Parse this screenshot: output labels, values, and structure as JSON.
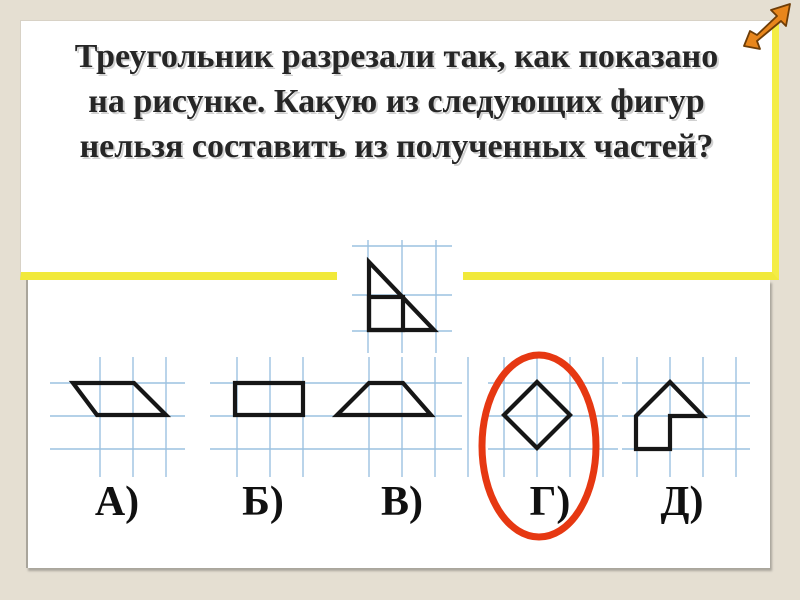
{
  "title": {
    "lines": [
      "Треугольник разрезали так, как показано",
      "на рисунке. Какую из следующих фигур",
      "нельзя составить из полученных частей?"
    ]
  },
  "figure": {
    "name": "cut-triangle-figure",
    "backing": [
      337,
      236,
      126,
      56
    ],
    "grid": {
      "v": [
        368,
        402,
        436
      ],
      "vy": [
        240,
        353
      ],
      "h": [
        246,
        295,
        331
      ],
      "hx": [
        352,
        452
      ]
    },
    "shapes": [
      {
        "polygon": [
          [
            369,
            262
          ],
          [
            369,
            330
          ],
          [
            434,
            330
          ]
        ]
      },
      {
        "rect": [
          369,
          297,
          34,
          33
        ]
      }
    ]
  },
  "options": [
    {
      "label": "А)",
      "name": "option-a-parallelogram",
      "circled": false,
      "grid": {
        "v": [
          100,
          133,
          166
        ],
        "vy": [
          357,
          477
        ],
        "h": [
          383,
          416,
          449
        ],
        "hx": [
          50,
          185
        ]
      },
      "shapes": [
        {
          "polygon": [
            [
              73,
              383
            ],
            [
              134,
              383
            ],
            [
              166,
              415
            ],
            [
              97,
              415
            ]
          ]
        }
      ]
    },
    {
      "label": "Б)",
      "name": "option-b-rectangle",
      "circled": false,
      "grid": {
        "v": [
          237,
          270,
          303
        ],
        "vy": [
          357,
          477
        ],
        "h": [
          383,
          416,
          449
        ],
        "hx": [
          210,
          318
        ]
      },
      "shapes": [
        {
          "polygon": [
            [
              235,
              383
            ],
            [
              303,
              383
            ],
            [
              303,
              415
            ],
            [
              235,
              415
            ]
          ]
        }
      ]
    },
    {
      "label": "В)",
      "name": "option-v-trapezoid",
      "circled": false,
      "grid": {
        "v": [
          369,
          402,
          435,
          468
        ],
        "vy": [
          357,
          477
        ],
        "h": [
          383,
          416,
          449
        ],
        "hx": [
          318,
          462
        ]
      },
      "shapes": [
        {
          "polygon": [
            [
              369,
              383
            ],
            [
              403,
              383
            ],
            [
              431,
              415
            ],
            [
              337,
              415
            ]
          ]
        }
      ]
    },
    {
      "label": "Г)",
      "name": "option-g-diamond",
      "circled": true,
      "grid": {
        "v": [
          504,
          537,
          570,
          603
        ],
        "vy": [
          357,
          477
        ],
        "h": [
          383,
          416,
          449
        ],
        "hx": [
          488,
          618
        ]
      },
      "shapes": [
        {
          "polygon": [
            [
              537,
              382
            ],
            [
              570,
              415
            ],
            [
              537,
              448
            ],
            [
              504,
              415
            ]
          ]
        }
      ]
    },
    {
      "label": "Д)",
      "name": "option-d-house",
      "circled": false,
      "grid": {
        "v": [
          637,
          670,
          703,
          736
        ],
        "vy": [
          357,
          477
        ],
        "h": [
          383,
          416,
          449
        ],
        "hx": [
          622,
          750
        ]
      },
      "shapes": [
        {
          "polygon": [
            [
              670,
              382
            ],
            [
              703,
              416
            ],
            [
              670,
              416
            ],
            [
              670,
              449
            ],
            [
              636,
              449
            ],
            [
              636,
              416
            ]
          ]
        }
      ]
    }
  ],
  "highlight": {
    "type": "ellipse",
    "cx": 539,
    "cy": 446,
    "rx": 57,
    "ry": 91
  },
  "arrow_icon": {
    "points": "790,4 771,10 777,16 757,35 750,31 744,46 760,49 757,41 781,21 786,26"
  },
  "colors": {
    "background": "#e5dfd2",
    "panel": "#ffffff",
    "accent_yellow": "#f4ed45",
    "grid_blue": "#9cc2e0",
    "shape_stroke": "#161616",
    "highlight_red": "#e63812",
    "arrow_orange": "#e8861c",
    "arrow_outline": "#6e3d07",
    "shadow": "#a9a59b"
  }
}
